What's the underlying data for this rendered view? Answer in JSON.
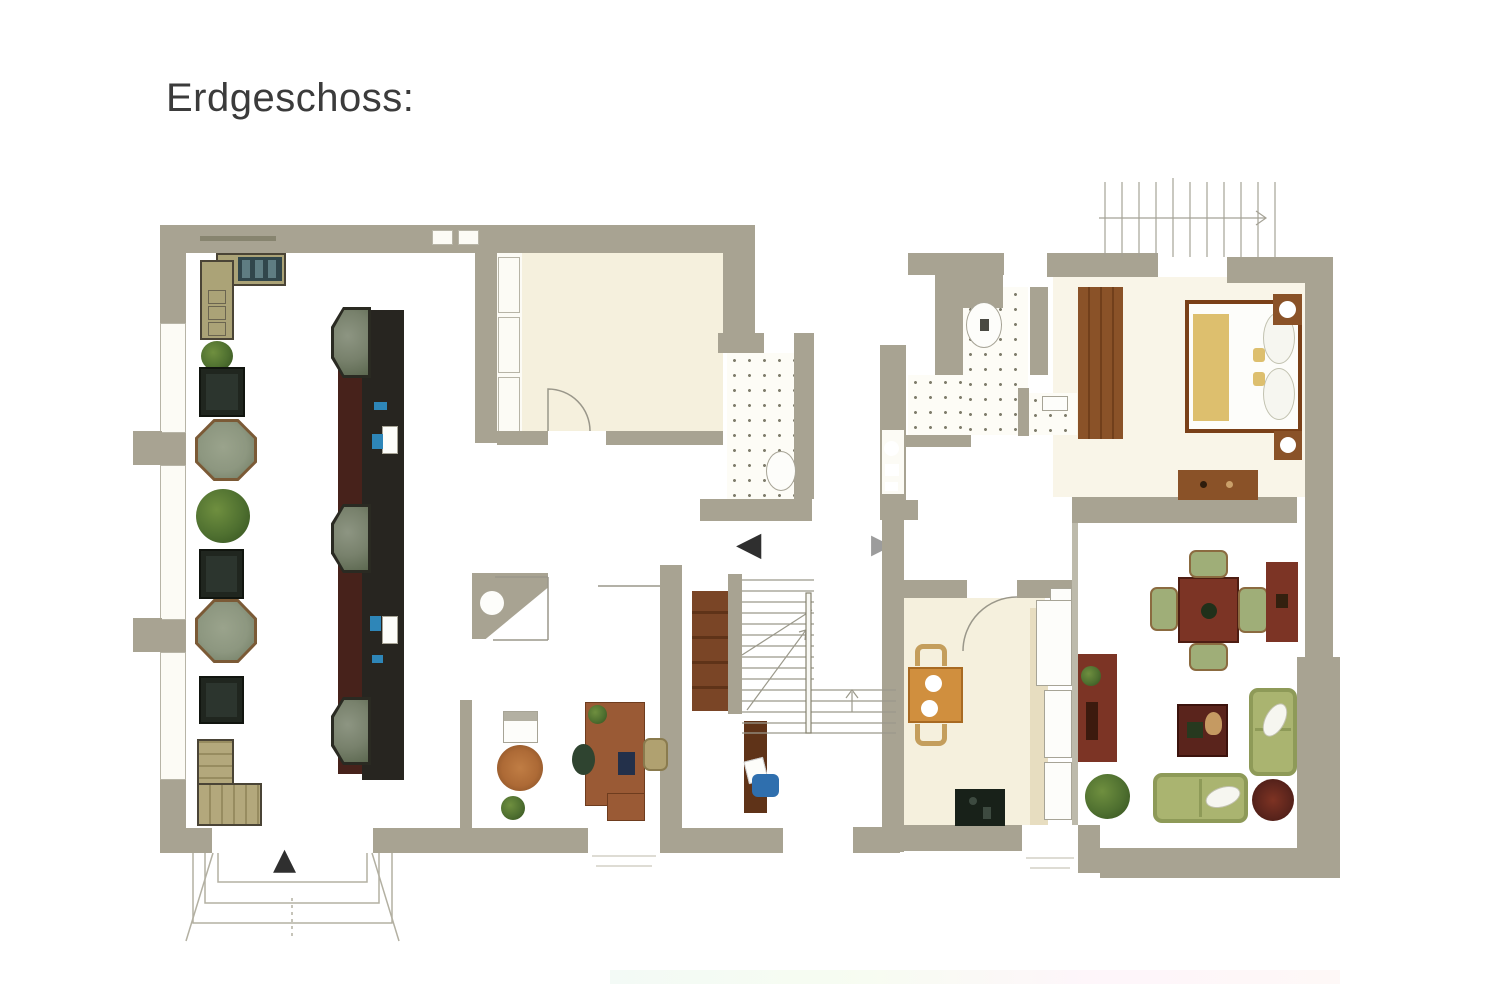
{
  "title": "Erdgeschoss:",
  "icons": {
    "entrance_arrow_up": "▲",
    "passage_arrow_left": "◀",
    "passage_arrow_right": "▶"
  },
  "palette": {
    "wall": "#a8a392",
    "wall2": "#bdbaab",
    "line": "#a29f91",
    "cream": "#f5f0dd",
    "tan": "#e7ddc0",
    "dot": "#7f7d6c",
    "bartop": "#272520",
    "barfront": "#47221b",
    "stone": "#78816c",
    "olive": "#aba377",
    "tdark": "#20261f",
    "oct": "#8d9780",
    "octb": "#7b5a36",
    "brown": "#8a5228",
    "wred": "#7c3425",
    "wreddk": "#5a241c",
    "sofa": "#a2ab6e",
    "tanchair": "#c49e5c",
    "yellow": "#ddbf6e",
    "orange": "#d08f3e",
    "stove": "#182119",
    "plant": "#4f7030",
    "plantdk": "#33501e",
    "rug": "#ad6a36",
    "blue": "#2e86b8",
    "bluechair": "#2f6fae",
    "adark": "#2f2f2f",
    "agray": "#9c9c9c",
    "title": "#3b3b3b"
  }
}
